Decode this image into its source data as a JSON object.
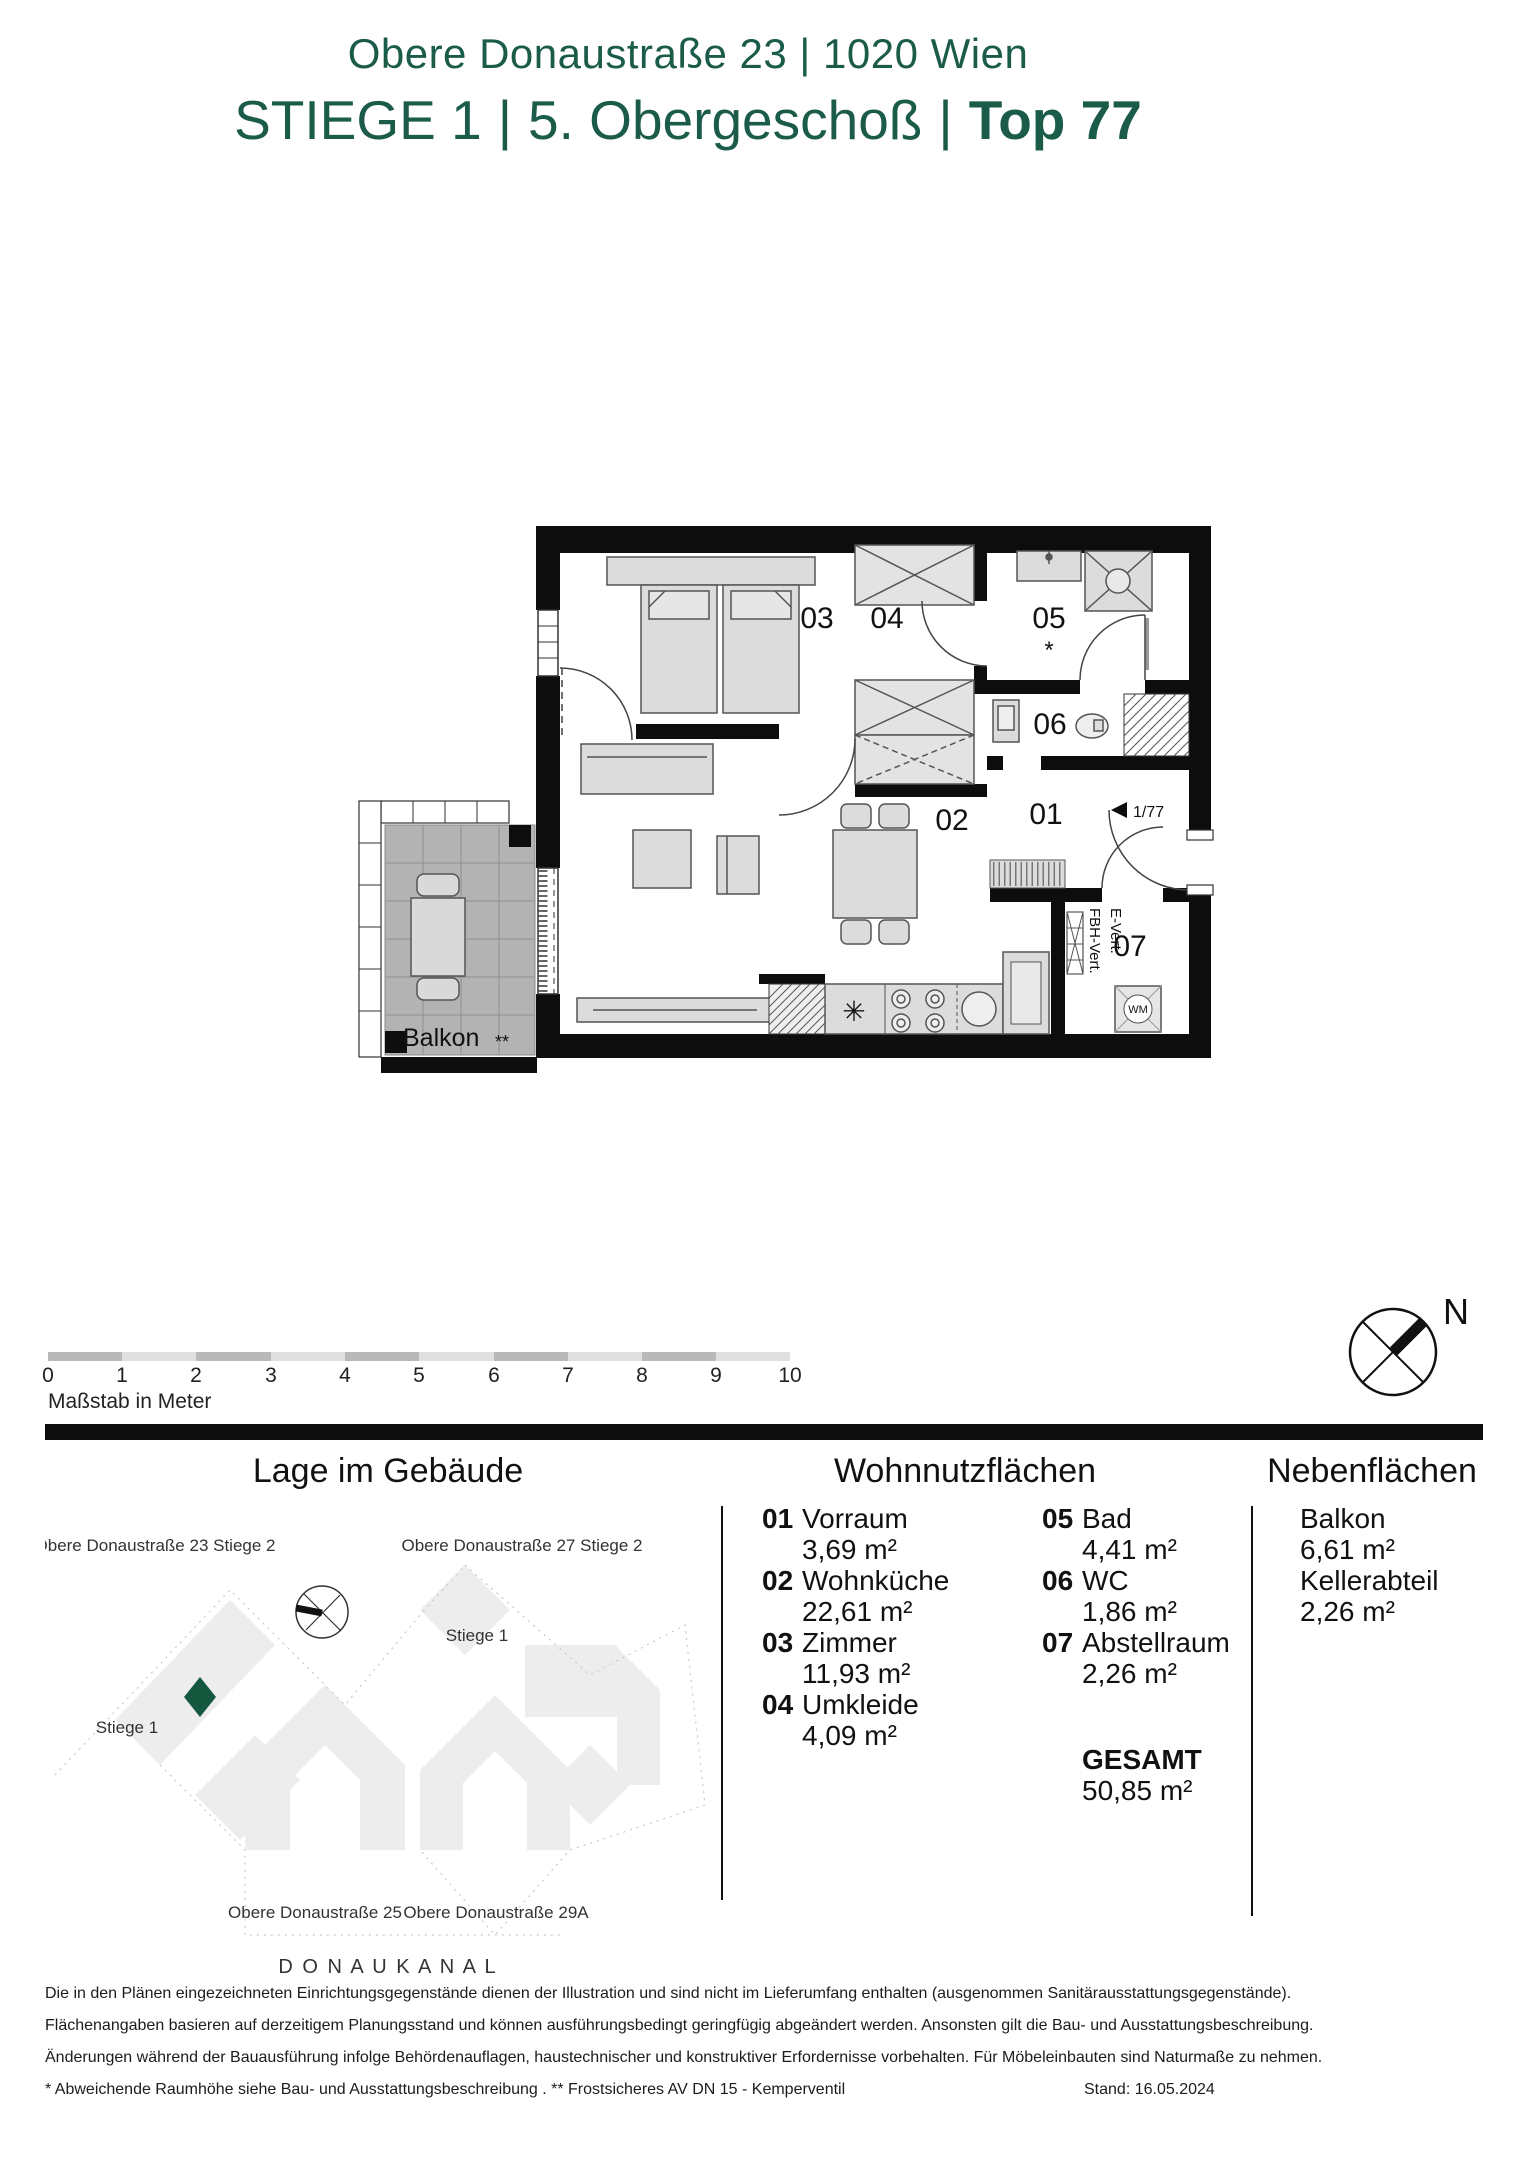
{
  "header": {
    "address": "Obere Donaustraße 23 | 1020 Wien",
    "stiege": "STIEGE 1",
    "sep1": "|",
    "floor": "5. Obergeschoß",
    "sep2": "|",
    "unit": "Top 77"
  },
  "plan": {
    "room_numbers": {
      "r01": "01",
      "r02": "02",
      "r03": "03",
      "r04": "04",
      "r05": "05",
      "r06": "06",
      "r07": "07"
    },
    "balkon": "Balkon",
    "balkon_note": "**",
    "bad_note": "*",
    "entry_label": "1/77",
    "wm": "WM",
    "shaft1": "FBH-Vert.",
    "shaft2": "E-Vert.",
    "kitchen_star": "✳"
  },
  "scalebar": {
    "ticks": [
      "0",
      "1",
      "2",
      "3",
      "4",
      "5",
      "6",
      "7",
      "8",
      "9",
      "10"
    ],
    "caption": "Maßstab in Meter"
  },
  "compass": {
    "label": "N"
  },
  "sections": {
    "site": "Lage im Gebäude",
    "main": "Wohnnutzflächen",
    "aux": "Nebenflächen"
  },
  "site": {
    "labels": {
      "b23": "Obere Donaustraße 23 Stiege 2",
      "b27": "Obere Donaustraße 27 Stiege 2",
      "stiege1_right": "Stiege 1",
      "stiege1_left": "Stiege 1",
      "b25": "Obere Donaustraße 25",
      "b29a": "Obere Donaustraße 29A",
      "kanal": "D O N A U K A N A L"
    }
  },
  "rooms": [
    {
      "num": "01",
      "name": "Vorraum",
      "area": "3,69 m²"
    },
    {
      "num": "02",
      "name": "Wohnküche",
      "area": "22,61 m²"
    },
    {
      "num": "03",
      "name": "Zimmer",
      "area": "11,93 m²"
    },
    {
      "num": "04",
      "name": "Umkleide",
      "area": "4,09 m²"
    },
    {
      "num": "05",
      "name": "Bad",
      "area": "4,41 m²"
    },
    {
      "num": "06",
      "name": "WC",
      "area": "1,86 m²"
    },
    {
      "num": "07",
      "name": "Abstellraum",
      "area": "2,26 m²"
    }
  ],
  "total": {
    "label": "GESAMT",
    "value": "50,85 m²"
  },
  "aux_rooms": [
    {
      "name": "Balkon",
      "area": "6,61 m²"
    },
    {
      "name": "Kellerabteil",
      "area": "2,26 m²"
    }
  ],
  "footer": {
    "lines": [
      "Die in den Plänen eingezeichneten Einrichtungsgegenstände dienen der Illustration und sind nicht im Lieferumfang enthalten (ausgenommen Sanitärausstattungsgegenstände).",
      "Flächenangaben basieren auf derzeitigem Planungsstand und können ausführungsbedingt geringfügig abgeändert werden. Ansonsten gilt die Bau- und Ausstattungsbeschreibung.",
      "Änderungen während der Bauausführung infolge Behördenauflagen, haustechnischer und konstruktiver Erfordernisse vorbehalten. Für Möbeleinbauten sind Naturmaße zu nehmen.",
      "* Abweichende Raumhöhe siehe Bau- und Ausstattungsbeschreibung . ** Frostsicheres AV DN 15 - Kemperventil"
    ],
    "stand": "Stand: 16.05.2024"
  },
  "colors": {
    "brand_green": "#1a5b49",
    "marker_green": "#155840"
  }
}
